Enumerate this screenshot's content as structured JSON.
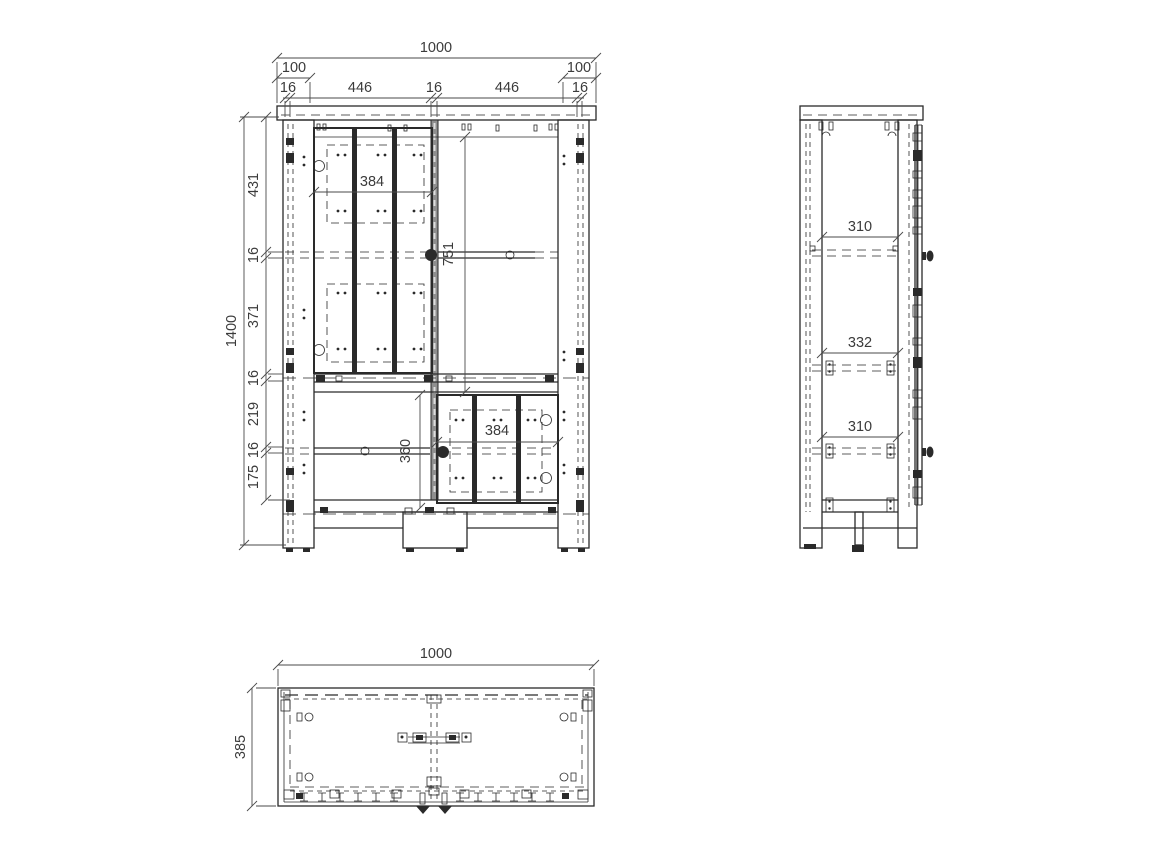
{
  "meta": {
    "drawing_type": "furniture cabinet orthographic technical drawing",
    "line_color": "#2a2a2a",
    "background": "#ffffff"
  },
  "front": {
    "overall_width": "1000",
    "overhang_left": "100",
    "overhang_right": "100",
    "top_chain": [
      "16",
      "446",
      "16",
      "446",
      "16"
    ],
    "overall_height": "1400",
    "height_chain": [
      "431",
      "16",
      "371",
      "16",
      "219",
      "16",
      "175"
    ],
    "upper_door_width": "384",
    "upper_interior_height": "751",
    "lower_door_width": "384",
    "lower_interior_height": "360"
  },
  "side": {
    "clear_top": "310",
    "clear_middle": "332",
    "clear_bottom": "310"
  },
  "top": {
    "overall_width": "1000",
    "overall_depth": "385"
  }
}
